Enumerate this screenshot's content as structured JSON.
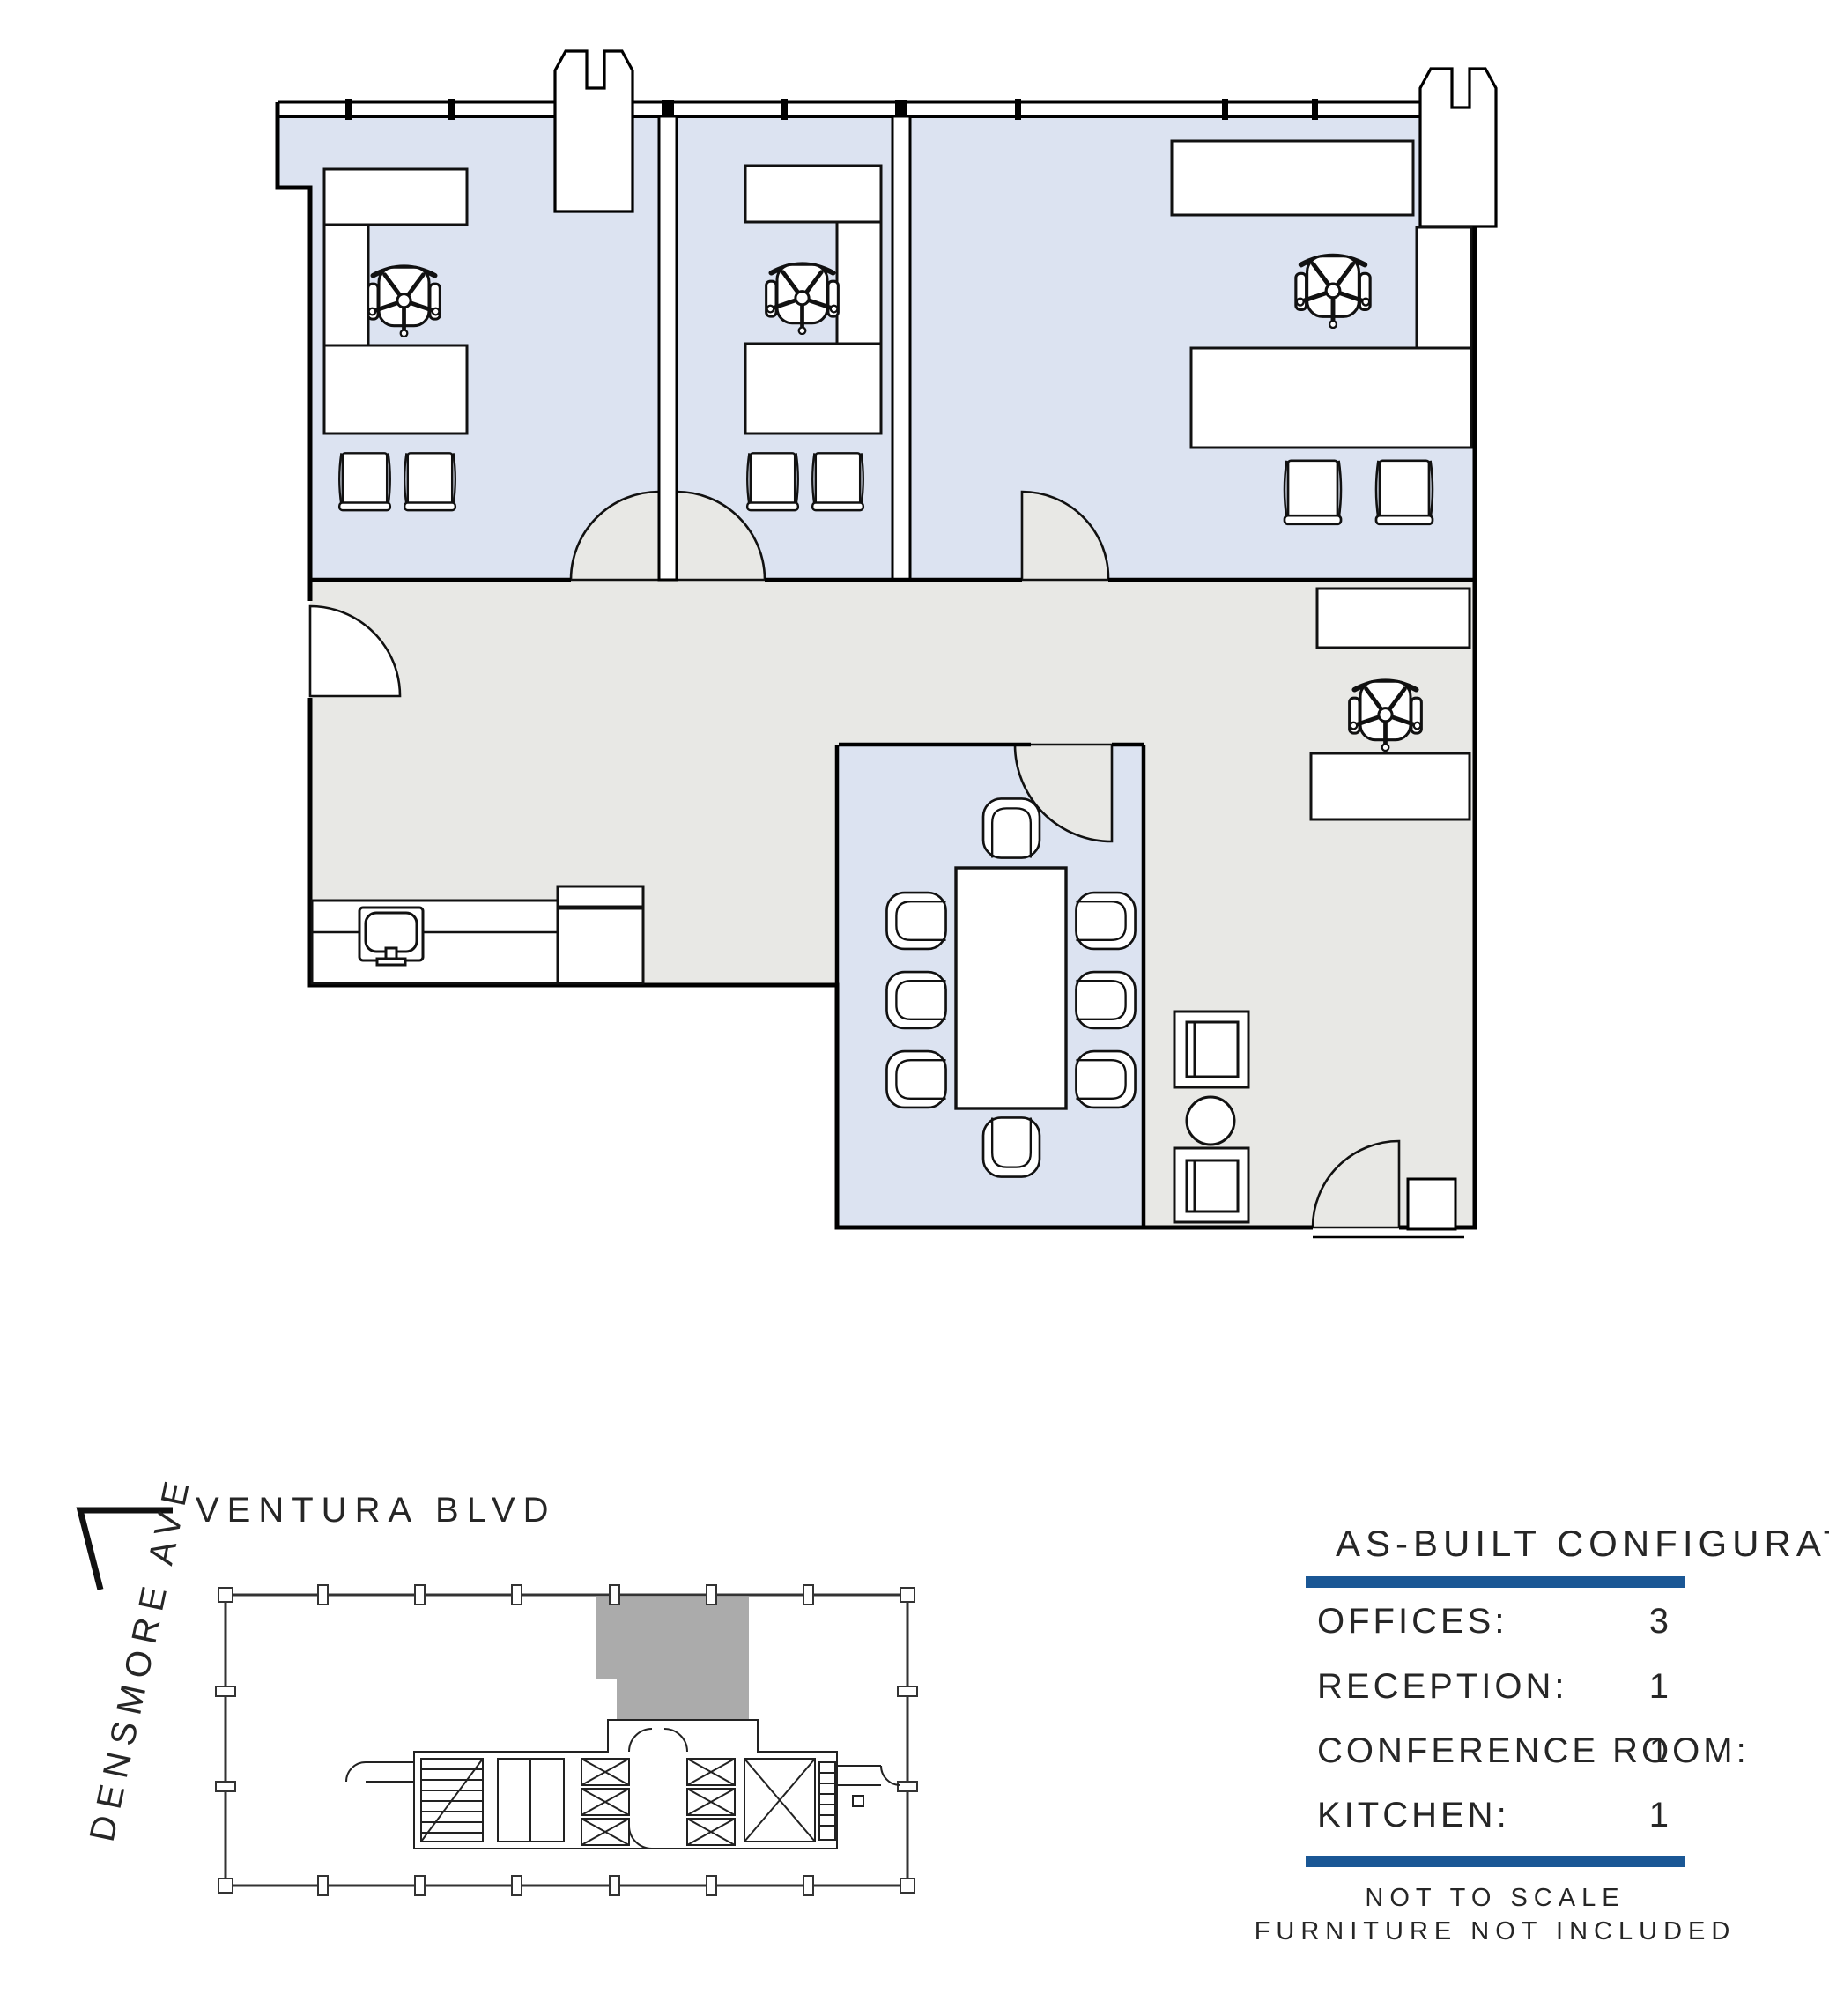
{
  "document": {
    "type": "as-built office suite floor plan",
    "background": "#ffffff"
  },
  "colors": {
    "accent_blue": "#1a5795",
    "room_fill": "#dce3f1",
    "circulation_fill": "#e8e8e5",
    "suite_highlight": "#ababab",
    "line": "#000000"
  },
  "streets": {
    "top": "VENTURA BLVD",
    "left": "DENSMORE AVE"
  },
  "legend": {
    "title": "AS-BUILT CONFIGURATION",
    "rows": [
      {
        "label": "OFFICES:",
        "value": "3"
      },
      {
        "label": "RECEPTION:",
        "value": "1"
      },
      {
        "label": "CONFERENCE ROOM:",
        "value": "1"
      },
      {
        "label": "KITCHEN:",
        "value": "1"
      }
    ],
    "notes": [
      "NOT TO SCALE",
      "FURNITURE NOT INCLUDED"
    ]
  }
}
